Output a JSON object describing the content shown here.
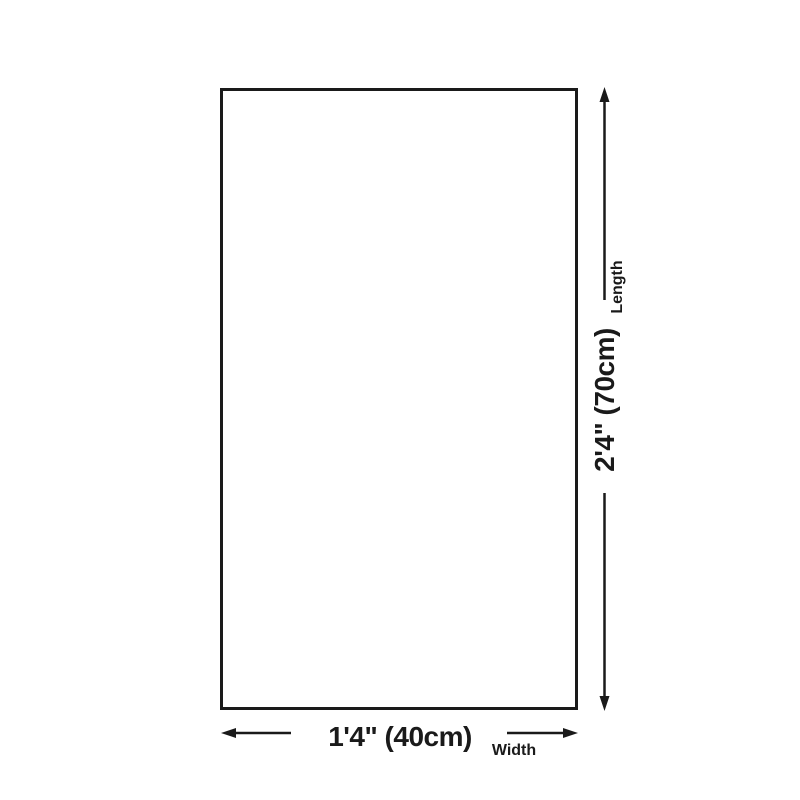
{
  "page": {
    "background_color": "#ffffff"
  },
  "diagram": {
    "type": "product-dimension-diagram",
    "line_color": "#1a1a1a",
    "text_color": "#1a1a1a",
    "length": {
      "value": "2'4\" (70cm)",
      "label": "Length"
    },
    "width": {
      "value": "1'4\" (40cm)",
      "label": "Width"
    }
  }
}
